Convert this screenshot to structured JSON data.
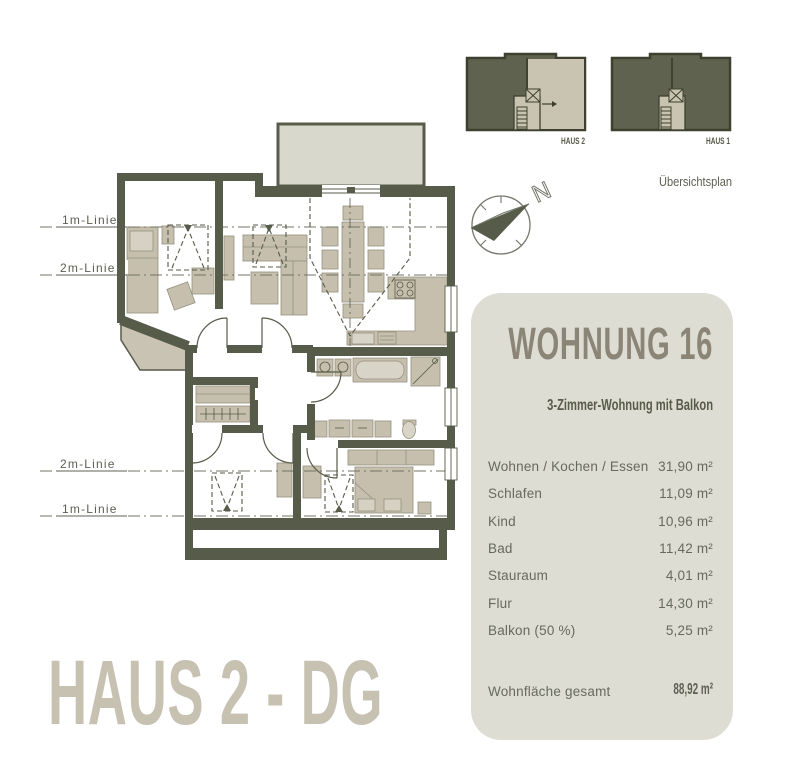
{
  "colors": {
    "wall": "#575b49",
    "furniture": "#c6bfae",
    "balcony": "#d9d8cc",
    "panel_background": "#deddd3",
    "panel_title": "#8b8577",
    "highlight_beige": "#c9c3b2",
    "overview_dark": "#5f624f",
    "sheet_title": "#c7c1b2"
  },
  "height_lines": {
    "top_1m": "1m-Linie",
    "top_2m": "2m-Linie",
    "bottom_2m": "2m-Linie",
    "bottom_1m": "1m-Linie"
  },
  "compass": {
    "north": "N"
  },
  "overview": {
    "haus2_label": "HAUS 2",
    "haus1_label": "HAUS 1",
    "caption": "Übersichtsplan"
  },
  "panel": {
    "title": "WOHNUNG 16",
    "subtitle": "3-Zimmer-Wohnung mit Balkon",
    "rooms": [
      {
        "label": "Wohnen / Kochen / Essen",
        "area": "31,90 m²"
      },
      {
        "label": "Schlafen",
        "area": "11,09 m²"
      },
      {
        "label": "Kind",
        "area": "10,96 m²"
      },
      {
        "label": "Bad",
        "area": "11,42 m²"
      },
      {
        "label": "Stauraum",
        "area": "4,01 m²"
      },
      {
        "label": "Flur",
        "area": "14,30 m²"
      },
      {
        "label": "Balkon (50 %)",
        "area": "5,25 m²"
      }
    ],
    "total_label": "Wohnfläche gesamt",
    "total_area": "88,92 m²"
  },
  "footer": {
    "title": "HAUS 2 - DG"
  }
}
